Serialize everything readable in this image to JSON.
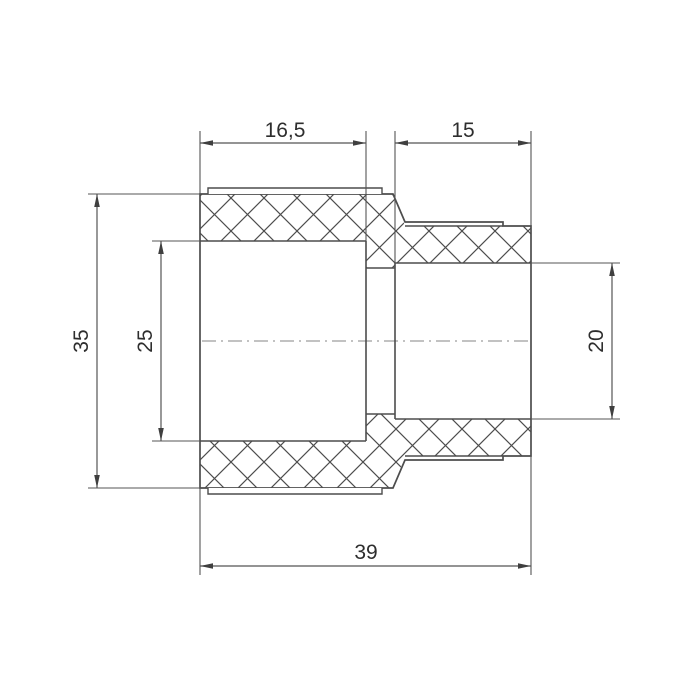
{
  "drawing": {
    "kind": "reducing-coupling-section-view",
    "dimensions": {
      "socket_left_length": "16,5",
      "socket_right_length": "15",
      "outer_diameter_left": "35",
      "inner_diameter_left": "25",
      "inner_diameter_right": "20",
      "total_length": "39"
    },
    "colors": {
      "line": "#4d4d4d",
      "dimension_line": "#555555",
      "centerline": "#9e9e9e",
      "text": "#2e2e2e",
      "background": "#ffffff"
    }
  }
}
